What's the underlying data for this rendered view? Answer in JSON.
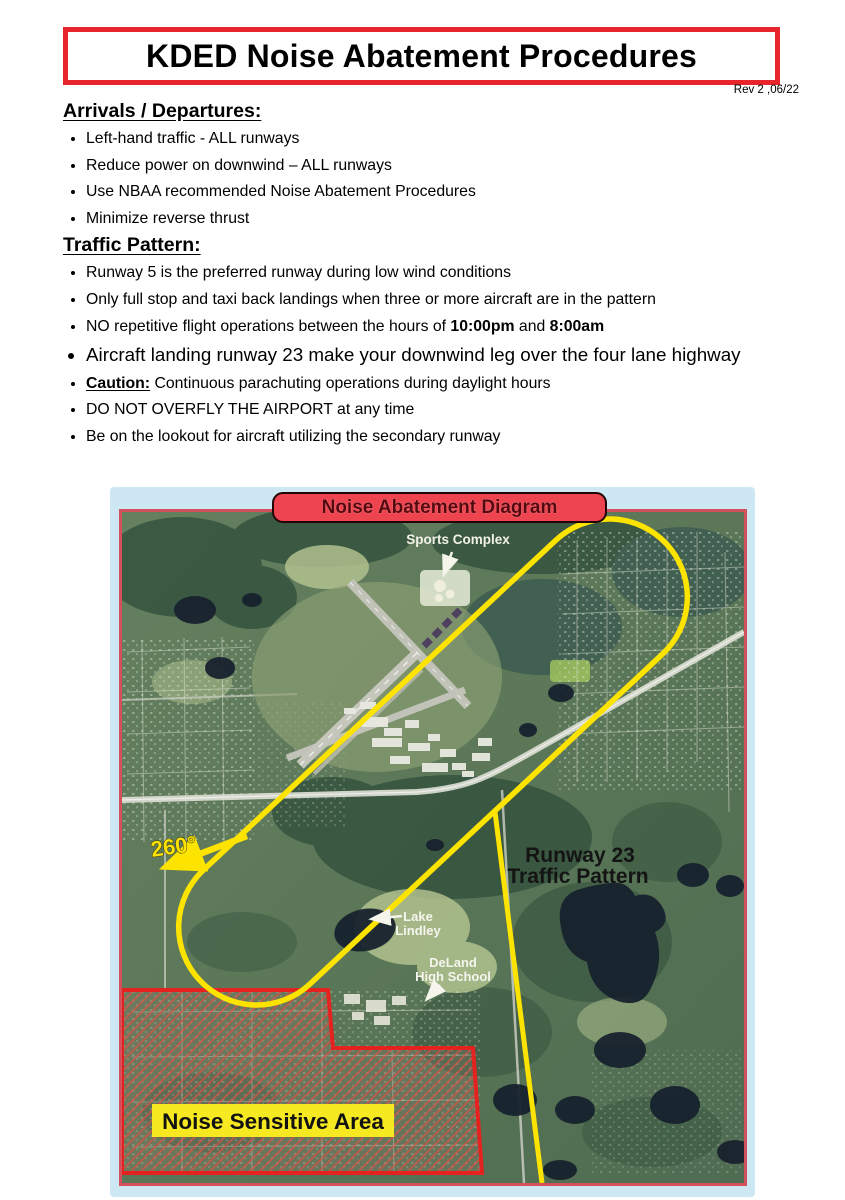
{
  "page": {
    "title": "KDED Noise Abatement Procedures",
    "revision": "Rev 2 ,06/22"
  },
  "arrivals": {
    "heading": "Arrivals / Departures:",
    "items": [
      "Left-hand traffic - ALL runways",
      "Reduce power on downwind – ALL runways",
      "Use NBAA recommended Noise Abatement Procedures",
      "Minimize reverse thrust"
    ]
  },
  "traffic": {
    "heading": "Traffic Pattern:",
    "item1": "Runway 5 is the preferred runway during low wind conditions",
    "item2": "Only full stop and taxi back landings when three or more aircraft are in the pattern",
    "item3_pre": "NO repetitive flight operations between the hours of ",
    "item3_bold1": "10:00pm",
    "item3_mid": " and ",
    "item3_bold2": "8:00am",
    "item4": "Aircraft landing runway 23 make your downwind leg over the four lane highway",
    "item5_label": "Caution:",
    "item5_text": " Continuous parachuting operations during daylight hours",
    "item6": "DO NOT OVERFLY THE AIRPORT at any time",
    "item7": "Be on the lookout for aircraft utilizing the secondary runway"
  },
  "diagram": {
    "banner": "Noise Abatement Diagram",
    "labels": {
      "sports_complex": "Sports Complex",
      "runway23_line1": "Runway 23",
      "runway23_line2": "Traffic Pattern",
      "lake_line1": "Lake",
      "lake_line2": "Lindley",
      "school_line1": "DeLand",
      "school_line2": "High School",
      "noise_area": "Noise Sensitive Area",
      "heading_260": "260°"
    },
    "colors": {
      "accent_red": "#e8252a",
      "banner_red": "#ee4450",
      "panel_blue": "#cde7f3",
      "pattern_yellow": "#fde300",
      "noise_border_red": "#e42320",
      "noise_label_yellow": "#f6e821"
    }
  }
}
